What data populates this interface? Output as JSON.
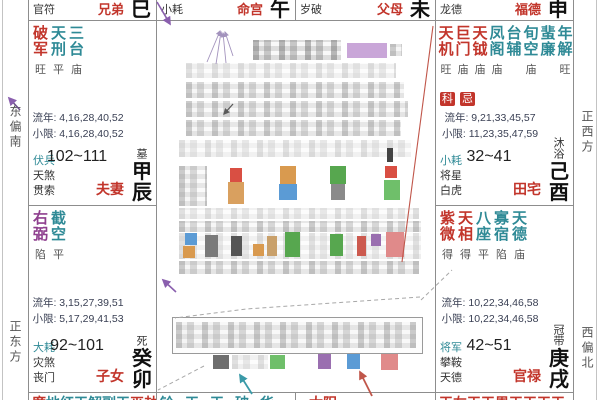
{
  "colors": {
    "major_star": "#c2352b",
    "minor_star": "#2f8a96",
    "aux_star": "#8e3f8e",
    "palace_name": "#c2352b",
    "badge_bg": "#c2352b",
    "badge_text": "#ffffff"
  },
  "directions": {
    "east_south": "东偏南",
    "east": "正东方",
    "west": "正西方",
    "west_north": "西偏北"
  },
  "top_row": [
    {
      "shensha": "官符",
      "palace": "兄弟",
      "branch": "巳"
    },
    {
      "shensha": "小耗",
      "palace": "命宫",
      "branch": "午"
    },
    {
      "shensha": "岁破",
      "palace": "父母",
      "branch": "未"
    },
    {
      "shensha": "龙德",
      "palace": "福德",
      "branch": "申"
    }
  ],
  "cells": {
    "chen": {
      "stars": [
        {
          "name": "破军",
          "bright": "旺",
          "cls": "major"
        },
        {
          "name": "天刑",
          "bright": "平",
          "cls": "minor"
        },
        {
          "name": "三台",
          "bright": "庙",
          "cls": "minor"
        }
      ],
      "liunian": "流年: 4,16,28,40,52",
      "xiaoxian": "小限: 4,16,28,40,52",
      "shensha": [
        {
          "name": "伏兵",
          "cls": "minor"
        },
        {
          "name": "天煞",
          "cls": "plain"
        },
        {
          "name": "贯索",
          "cls": "plain"
        }
      ],
      "ages": "102~111",
      "state": "墓",
      "stem": "甲辰",
      "palace": "夫妻"
    },
    "you": {
      "stars": [
        {
          "name": "天机",
          "bright": "旺",
          "cls": "major"
        },
        {
          "name": "巨门",
          "bright": "庙",
          "cls": "major"
        },
        {
          "name": "天钺",
          "bright": "庙",
          "cls": "major"
        },
        {
          "name": "凤阁",
          "bright": "庙",
          "cls": "minor"
        },
        {
          "name": "台辅",
          "bright": "",
          "cls": "minor"
        },
        {
          "name": "旬空",
          "bright": "庙",
          "cls": "minor"
        },
        {
          "name": "蜚廉",
          "bright": "",
          "cls": "minor"
        },
        {
          "name": "年解",
          "bright": "旺",
          "cls": "minor"
        }
      ],
      "badges": [
        "科",
        "忌"
      ],
      "liunian": "流年: 9,21,33,45,57",
      "xiaoxian": "小限: 11,23,35,47,59",
      "shensha": [
        {
          "name": "小耗",
          "cls": "minor"
        },
        {
          "name": "将星",
          "cls": "plain"
        },
        {
          "name": "白虎",
          "cls": "plain"
        }
      ],
      "ages": "32~41",
      "state": "沐浴",
      "stem": "己酉",
      "palace": "田宅"
    },
    "mao": {
      "stars": [
        {
          "name": "右弼",
          "bright": "陷",
          "cls": "aux"
        },
        {
          "name": "截空",
          "bright": "平",
          "cls": "minor"
        }
      ],
      "liunian": "流年: 3,15,27,39,51",
      "xiaoxian": "小限: 5,17,29,41,53",
      "shensha": [
        {
          "name": "大耗",
          "cls": "minor"
        },
        {
          "name": "灾煞",
          "cls": "plain"
        },
        {
          "name": "丧门",
          "cls": "plain"
        }
      ],
      "ages": "92~101",
      "state": "死",
      "stem": "癸卯",
      "palace": "子女"
    },
    "xu": {
      "stars": [
        {
          "name": "紫微",
          "bright": "得",
          "cls": "major"
        },
        {
          "name": "天相",
          "bright": "得",
          "cls": "major"
        },
        {
          "name": "八座",
          "bright": "平",
          "cls": "minor"
        },
        {
          "name": "寡宿",
          "bright": "陷",
          "cls": "minor"
        },
        {
          "name": "天德",
          "bright": "庙",
          "cls": "minor"
        }
      ],
      "liunian": "流年: 10,22,34,46,58",
      "xiaoxian": "小限: 10,22,34,46,58",
      "shensha": [
        {
          "name": "将军",
          "cls": "minor"
        },
        {
          "name": "攀鞍",
          "cls": "plain"
        },
        {
          "name": "天德",
          "cls": "plain"
        }
      ],
      "ages": "42~51",
      "state": "冠带",
      "stem": "庚戌",
      "palace": "官禄"
    }
  },
  "bottom_row": [
    {
      "chars": [
        {
          "t": "廉",
          "cls": "major"
        },
        {
          "t": "地",
          "cls": "minor"
        },
        {
          "t": "红",
          "cls": "minor"
        },
        {
          "t": "天",
          "cls": "minor"
        },
        {
          "t": "解",
          "cls": "minor"
        },
        {
          "t": "副",
          "cls": "minor"
        },
        {
          "t": "天",
          "cls": "minor"
        },
        {
          "t": "巫",
          "cls": "major"
        },
        {
          "t": "劫",
          "cls": "major"
        }
      ]
    },
    {
      "chars": [
        {
          "t": "铃",
          "cls": "minor"
        },
        {
          "t": "天",
          "cls": "minor"
        },
        {
          "t": "天",
          "cls": "minor"
        },
        {
          "t": "破",
          "cls": "minor"
        },
        {
          "t": "华",
          "cls": "minor"
        }
      ]
    },
    {
      "chars": [
        {
          "t": "太",
          "cls": "major"
        },
        {
          "t": "阳",
          "cls": "major"
        }
      ]
    },
    {
      "chars": [
        {
          "t": "天",
          "cls": "major"
        },
        {
          "t": "左",
          "cls": "major"
        },
        {
          "t": "天",
          "cls": "major"
        },
        {
          "t": "天",
          "cls": "major"
        },
        {
          "t": "恩",
          "cls": "major"
        },
        {
          "t": "天",
          "cls": "major"
        },
        {
          "t": "天",
          "cls": "major"
        },
        {
          "t": "天",
          "cls": "major"
        },
        {
          "t": "天",
          "cls": "major"
        }
      ]
    }
  ]
}
